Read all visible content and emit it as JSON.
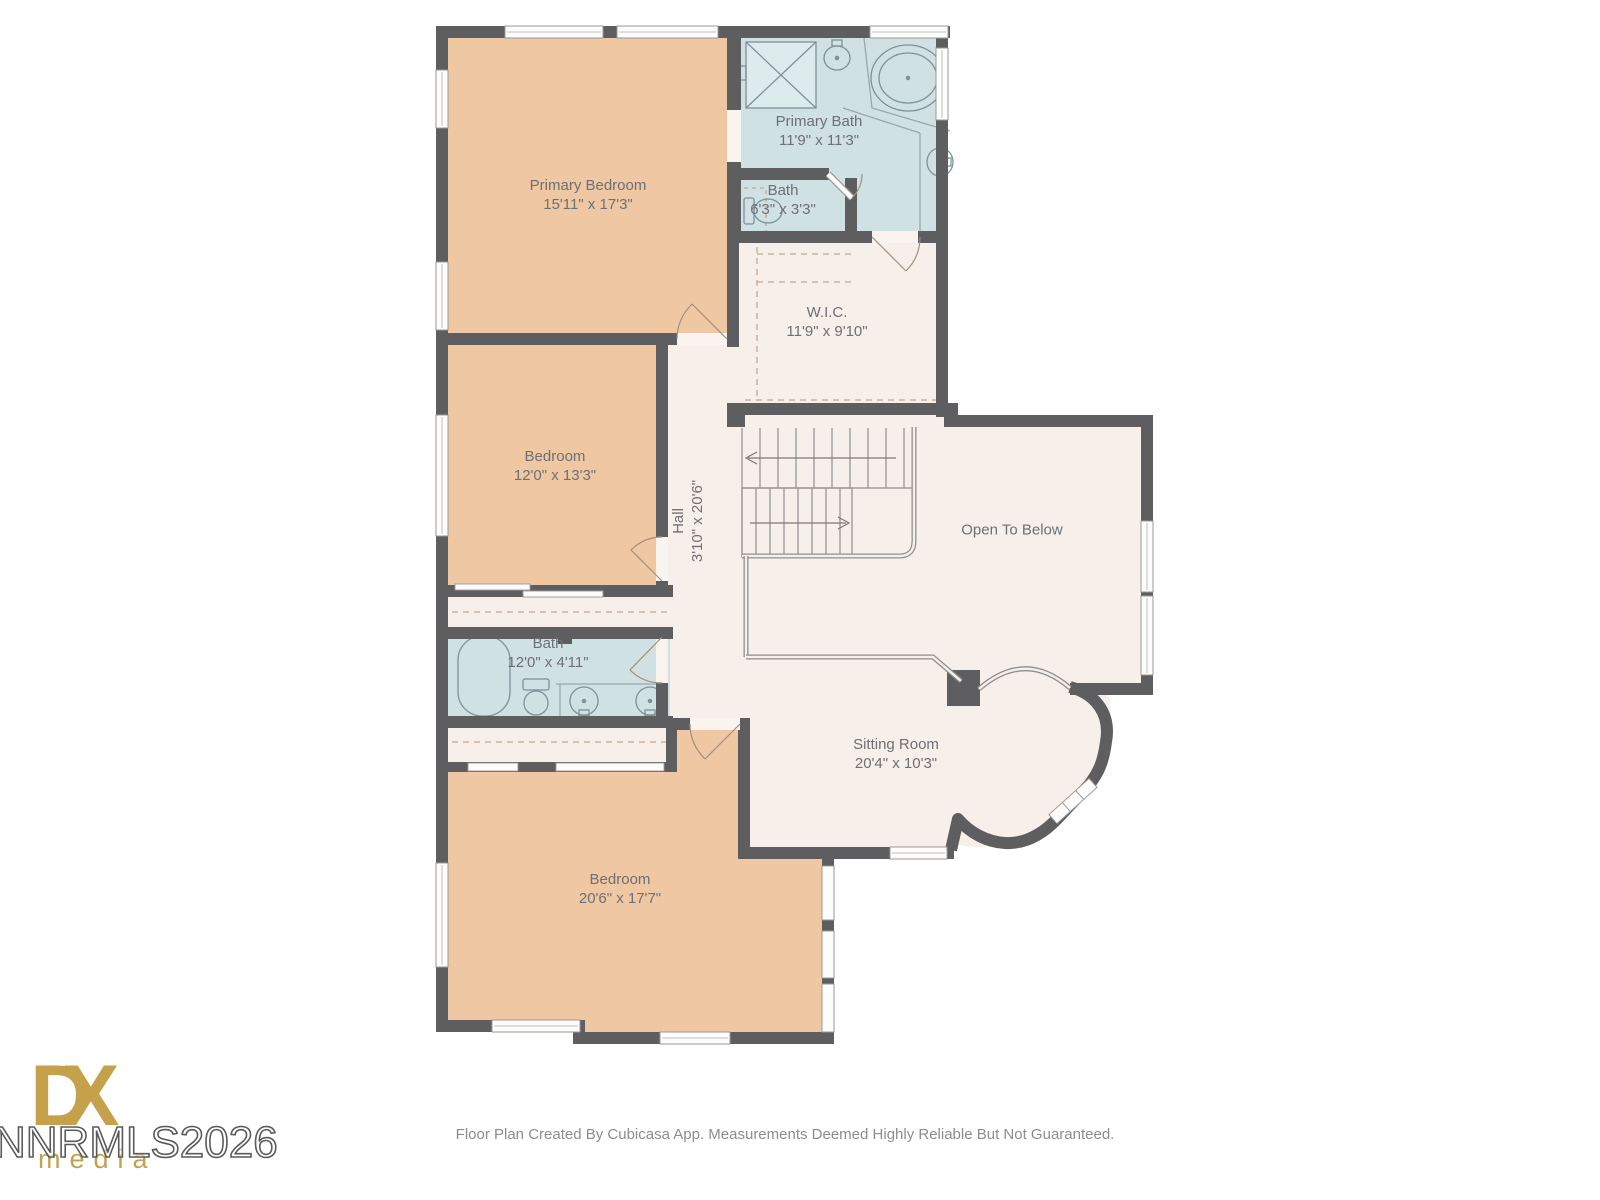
{
  "plan": {
    "rooms": [
      {
        "id": "primary-bedroom",
        "name": "Primary Bedroom",
        "dims": "15'11\" x 17'3\""
      },
      {
        "id": "primary-bath",
        "name": "Primary Bath",
        "dims": "11'9\" x 11'3\""
      },
      {
        "id": "bath-upper",
        "name": "Bath",
        "dims": "6'3\" x 3'3\""
      },
      {
        "id": "wic",
        "name": "W.I.C.",
        "dims": "11'9\" x 9'10\""
      },
      {
        "id": "bedroom-middle",
        "name": "Bedroom",
        "dims": "12'0\" x 13'3\""
      },
      {
        "id": "hall",
        "name": "Hall",
        "dims": "3'10\" x 20'6\""
      },
      {
        "id": "open-to-below",
        "name": "Open To Below",
        "dims": ""
      },
      {
        "id": "bath-middle",
        "name": "Bath",
        "dims": "12'0\" x 4'11\""
      },
      {
        "id": "sitting-room",
        "name": "Sitting Room",
        "dims": "20'4\" x 10'3\""
      },
      {
        "id": "bedroom-bottom",
        "name": "Bedroom",
        "dims": "20'6\" x 17'7\""
      }
    ],
    "colors": {
      "wall": "#5e5d5f",
      "bedroom_fill": "#efc7a3",
      "bath_fill": "#cfe1e3",
      "floor_fill": "#f7efe9",
      "window_fill": "#fdfcfa",
      "logo_gold": "#c6a14b"
    }
  },
  "branding": {
    "logo_line1": "DX",
    "logo_letter_d": "D",
    "logo_letter_x": "X",
    "logo_line2": "media",
    "watermark": "NNRMLS2026"
  },
  "footer": {
    "disclaimer": "Floor Plan Created By Cubicasa App. Measurements Deemed Highly Reliable But Not Guaranteed."
  }
}
